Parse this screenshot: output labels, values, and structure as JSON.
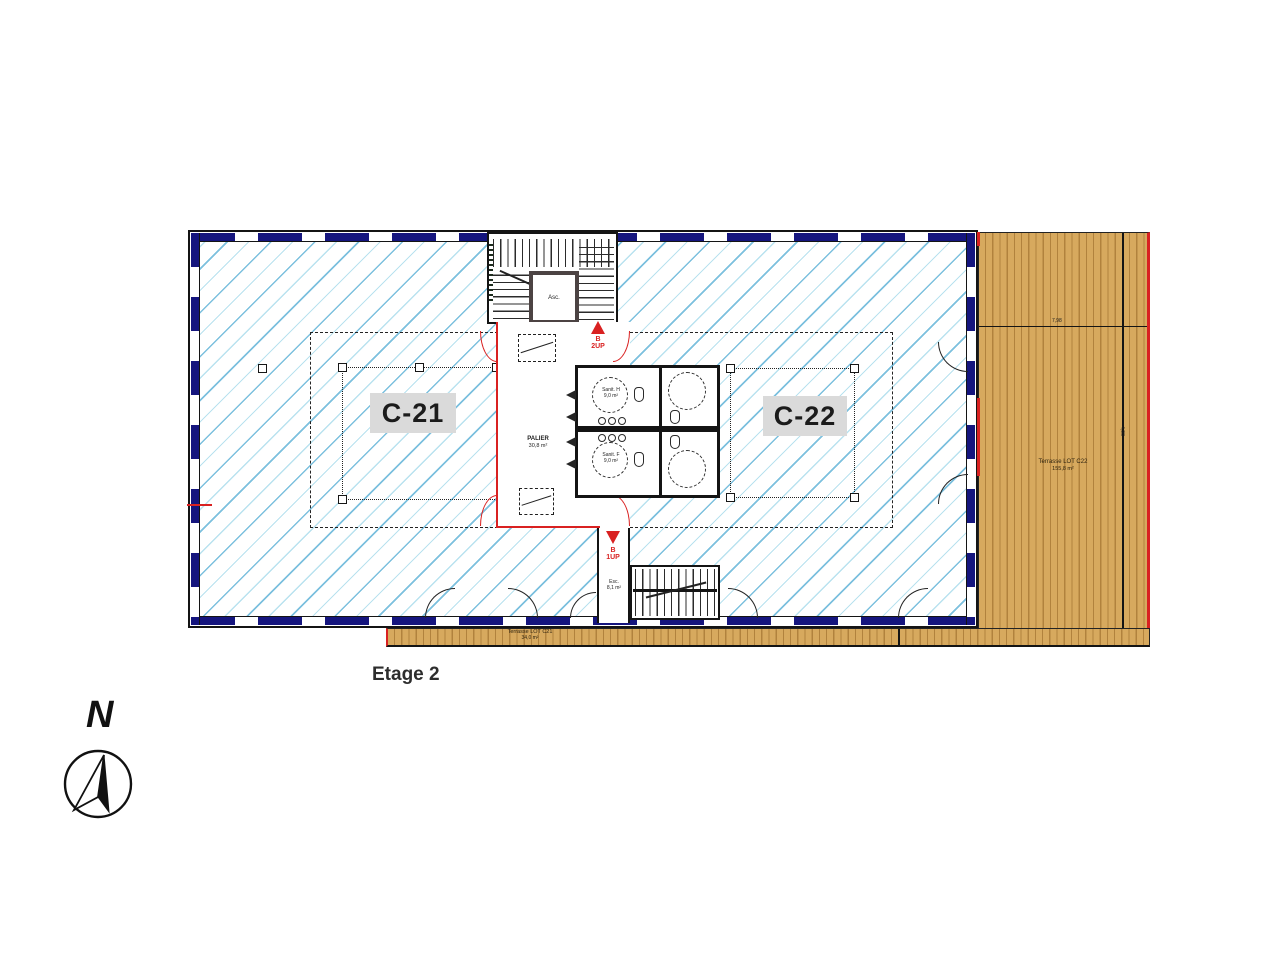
{
  "plan": {
    "floor_label": "Etage 2",
    "compass_label": "N",
    "zones": [
      {
        "id": "C-21"
      },
      {
        "id": "C-22"
      }
    ],
    "core": {
      "elevator": "Asc.",
      "palier": "PALIER",
      "palier_area": "30,8 m²",
      "sanit_h": "Sanit. H",
      "sanit_h_area": "9,0 m²",
      "sanit_f": "Sanit. F",
      "sanit_f_area": "9,0 m²",
      "esc": "Esc.",
      "esc_area": "8,1 m²",
      "stair_up_letter": "B",
      "stair_up": "2UP",
      "stair_down_letter": "B",
      "stair_down": "1UP"
    },
    "terraces": {
      "right_label": "Terrasse LOT C22",
      "right_area": "155,8 m²",
      "bottom_label": "Terrasse LOT C21",
      "bottom_area": "34,0 m²"
    },
    "dims": {
      "width": "7,98",
      "height": "4,98"
    },
    "colors": {
      "window_navy": "#15157e",
      "hatch_blue": "#7cc0de",
      "lot_red": "#d92121",
      "wood": "#d7a95e"
    }
  }
}
